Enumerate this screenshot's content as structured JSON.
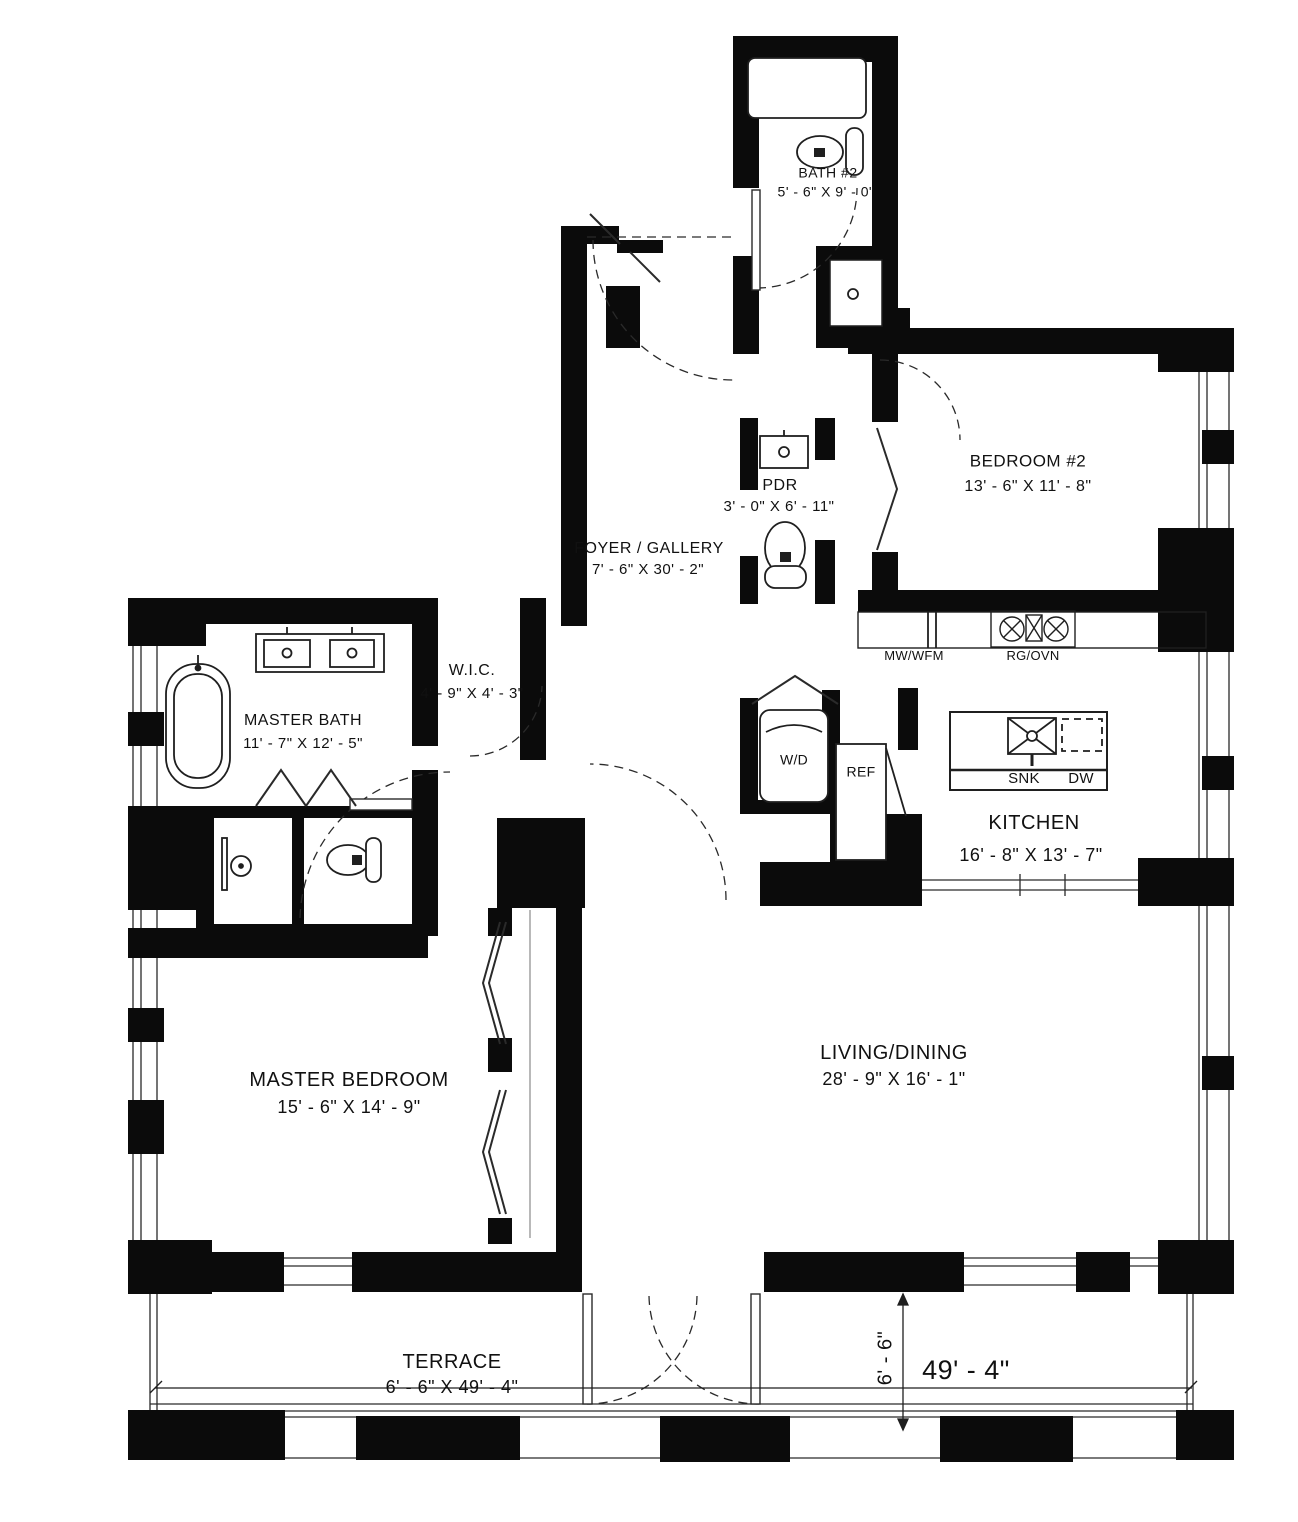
{
  "rooms": {
    "bath2": {
      "name": "BATH #2",
      "dims": "5' - 6\" X  9' - 0\""
    },
    "bedroom2": {
      "name": "BEDROOM #2",
      "dims": "13' - 6\" X  11' - 8\""
    },
    "pdr": {
      "name": "PDR",
      "dims": "3' - 0\" X  6' - 11\""
    },
    "foyer": {
      "name": "FOYER / GALLERY",
      "dims": "7' - 6\" X  30' - 2\""
    },
    "wic": {
      "name": "W.I.C.",
      "dims": "4' - 9\" X  4' - 3\""
    },
    "master_bath": {
      "name": "MASTER BATH",
      "dims": "11' - 7\" X  12' - 5\""
    },
    "kitchen": {
      "name": "KITCHEN",
      "dims": "16' - 8\" X  13' - 7\""
    },
    "master_bedroom": {
      "name": "MASTER BEDROOM",
      "dims": "15' - 6\" X  14' - 9\""
    },
    "living_dining": {
      "name": "LIVING/DINING",
      "dims": "28' - 9\" X  16' - 1\""
    },
    "terrace": {
      "name": "TERRACE",
      "dims": "6' - 6\" X 49' - 4\""
    }
  },
  "appliances": {
    "mw_wfm": "MW/WFM",
    "rg_ovn": "RG/OVN",
    "wd": "W/D",
    "ref": "REF",
    "snk": "SNK",
    "dw": "DW"
  },
  "dimensions": {
    "terrace_length": "49' - 4\"",
    "terrace_depth": "6' - 6\""
  },
  "colors": {
    "wall": "#0b0b0b",
    "line": "#1f1f1f",
    "background": "#ffffff"
  }
}
